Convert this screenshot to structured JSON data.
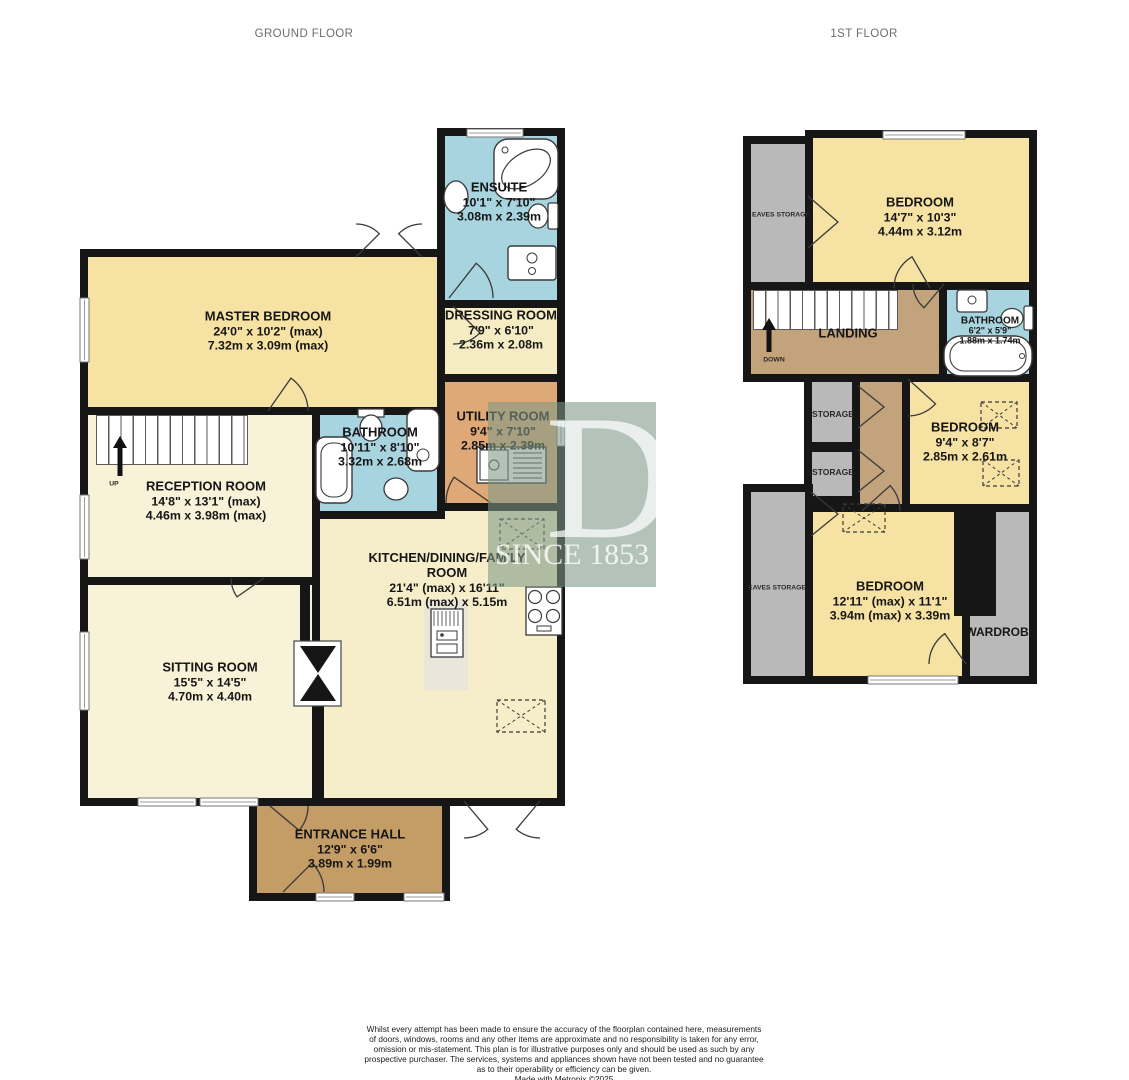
{
  "titles": {
    "ground": "GROUND FLOOR",
    "first": "1ST FLOOR"
  },
  "ground_floor": {
    "rooms": {
      "ensuite": {
        "name": "ENSUITE",
        "imperial": "10'1\" x 7'10\"",
        "metric": "3.08m x 2.39m"
      },
      "master_bedroom": {
        "name": "MASTER BEDROOM",
        "imperial": "24'0\" x 10'2\" (max)",
        "metric": "7.32m x 3.09m (max)"
      },
      "dressing_room": {
        "name": "DRESSING ROOM",
        "imperial": "7'9\" x 6'10\"",
        "metric": "2.36m x 2.08m"
      },
      "bathroom": {
        "name": "BATHROOM",
        "imperial": "10'11\" x 8'10\"",
        "metric": "3.32m x 2.68m"
      },
      "utility_room": {
        "name": "UTILITY ROOM",
        "imperial": "9'4\" x 7'10\"",
        "metric": "2.85m x 2.39m"
      },
      "reception_room": {
        "name": "RECEPTION ROOM",
        "imperial": "14'8\" x 13'1\" (max)",
        "metric": "4.46m x 3.98m (max)"
      },
      "kitchen": {
        "name": "KITCHEN/DINING/FAMILY",
        "name2": "ROOM",
        "imperial": "21'4\" (max) x 16'11\"",
        "metric": "6.51m (max) x 5.15m"
      },
      "sitting_room": {
        "name": "SITTING ROOM",
        "imperial": "15'5\" x 14'5\"",
        "metric": "4.70m x 4.40m"
      },
      "entrance_hall": {
        "name": "ENTRANCE HALL",
        "imperial": "12'9\" x 6'6\"",
        "metric": "3.89m x 1.99m"
      }
    },
    "stairs": {
      "up": "UP"
    }
  },
  "first_floor": {
    "rooms": {
      "eaves_storage_top": {
        "name": "EAVES STORAGE"
      },
      "bedroom1": {
        "name": "BEDROOM",
        "imperial": "14'7\" x 10'3\"",
        "metric": "4.44m x 3.12m"
      },
      "landing": {
        "name": "LANDING"
      },
      "bathroom": {
        "name": "BATHROOM",
        "imperial": "6'2\" x 5'9\"",
        "metric": "1.88m x 1.74m"
      },
      "storage1": {
        "name": "STORAGE"
      },
      "storage2": {
        "name": "STORAGE"
      },
      "bedroom2": {
        "name": "BEDROOM",
        "imperial": "9'4\" x 8'7\"",
        "metric": "2.85m x 2.61m"
      },
      "eaves_storage_bottom": {
        "name": "EAVES STORAGE"
      },
      "bedroom3": {
        "name": "BEDROOM",
        "imperial": "12'11\" (max) x 11'1\"",
        "metric": "3.94m (max) x 3.39m"
      },
      "wardrobe": {
        "name": "WARDROBE"
      }
    },
    "stairs": {
      "down": "DOWN"
    }
  },
  "watermark": {
    "letter": "D",
    "text": "SINCE 1853"
  },
  "disclaimer": [
    "Whilst every attempt has been made to ensure the accuracy of the floorplan contained here, measurements",
    "of doors, windows, rooms and any other items are approximate and no responsibility is taken for any error,",
    "omission or mis-statement. This plan is for illustrative purposes only and should be used as such by any",
    "prospective purchaser. The services, systems and appliances shown have not been tested and no guarantee",
    "as to their operability or efficiency can be given.",
    "Made with Metropix ©2025"
  ],
  "colors": {
    "bedroom_yellow": "#f6e2a2",
    "bathroom_blue": "#a8d4e0",
    "living_cream": "#f8f2d8",
    "kitchen_cream": "#f5eec9",
    "utility_orange": "#dfa977",
    "hall_brown": "#c39c66",
    "landing_tan": "#c2a37b",
    "storage_gray": "#b9b9b9",
    "wall_black": "#161616",
    "watermark_green": "#7c9886"
  },
  "icons": {
    "fixtures": [
      "bath-icon",
      "corner-bath-icon",
      "toilet-icon",
      "sink-icon",
      "basin-icon",
      "shower-unit-icon",
      "stove-icon",
      "fridge-icon",
      "utility-sink-icon",
      "loft-hatch-icon",
      "chimney-icon",
      "stairs-up-icon",
      "stairs-down-icon",
      "door-arc-icon",
      "bifold-door-icon",
      "window-icon",
      "direction-arrow-icon"
    ]
  }
}
